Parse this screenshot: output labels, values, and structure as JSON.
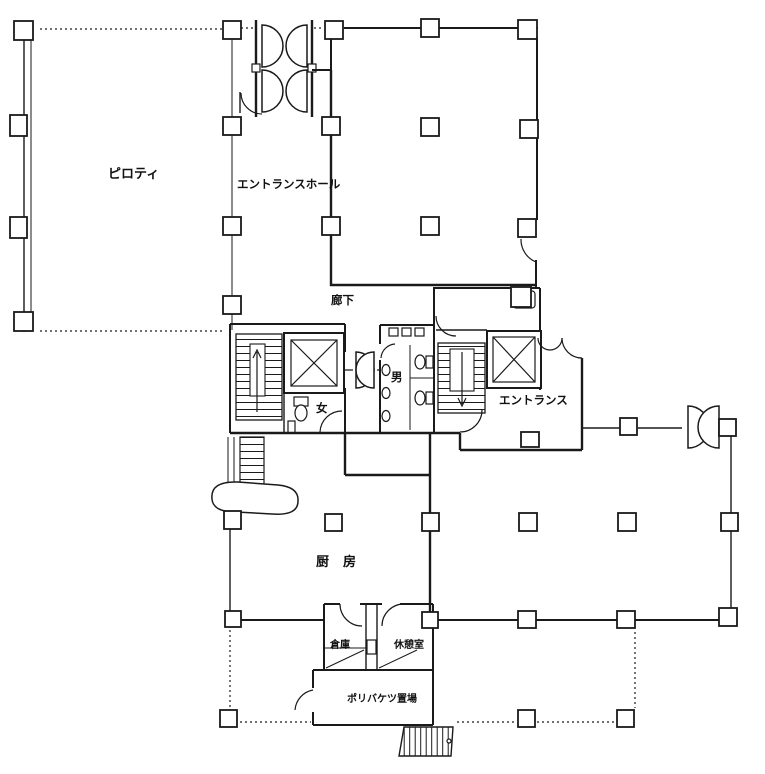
{
  "labels": {
    "piloti": "ピロティ",
    "entrance_hall": "エントランスホール",
    "corridor": "廊下",
    "men": "男",
    "women": "女",
    "entrance": "エントランス",
    "kitchen": "厨房",
    "storage": "倉庫",
    "break_room": "休憩室",
    "bucket_storage": "ポリバケツ置場"
  },
  "colors": {
    "line": "#1a1a1a",
    "paper": "#ffffff"
  }
}
